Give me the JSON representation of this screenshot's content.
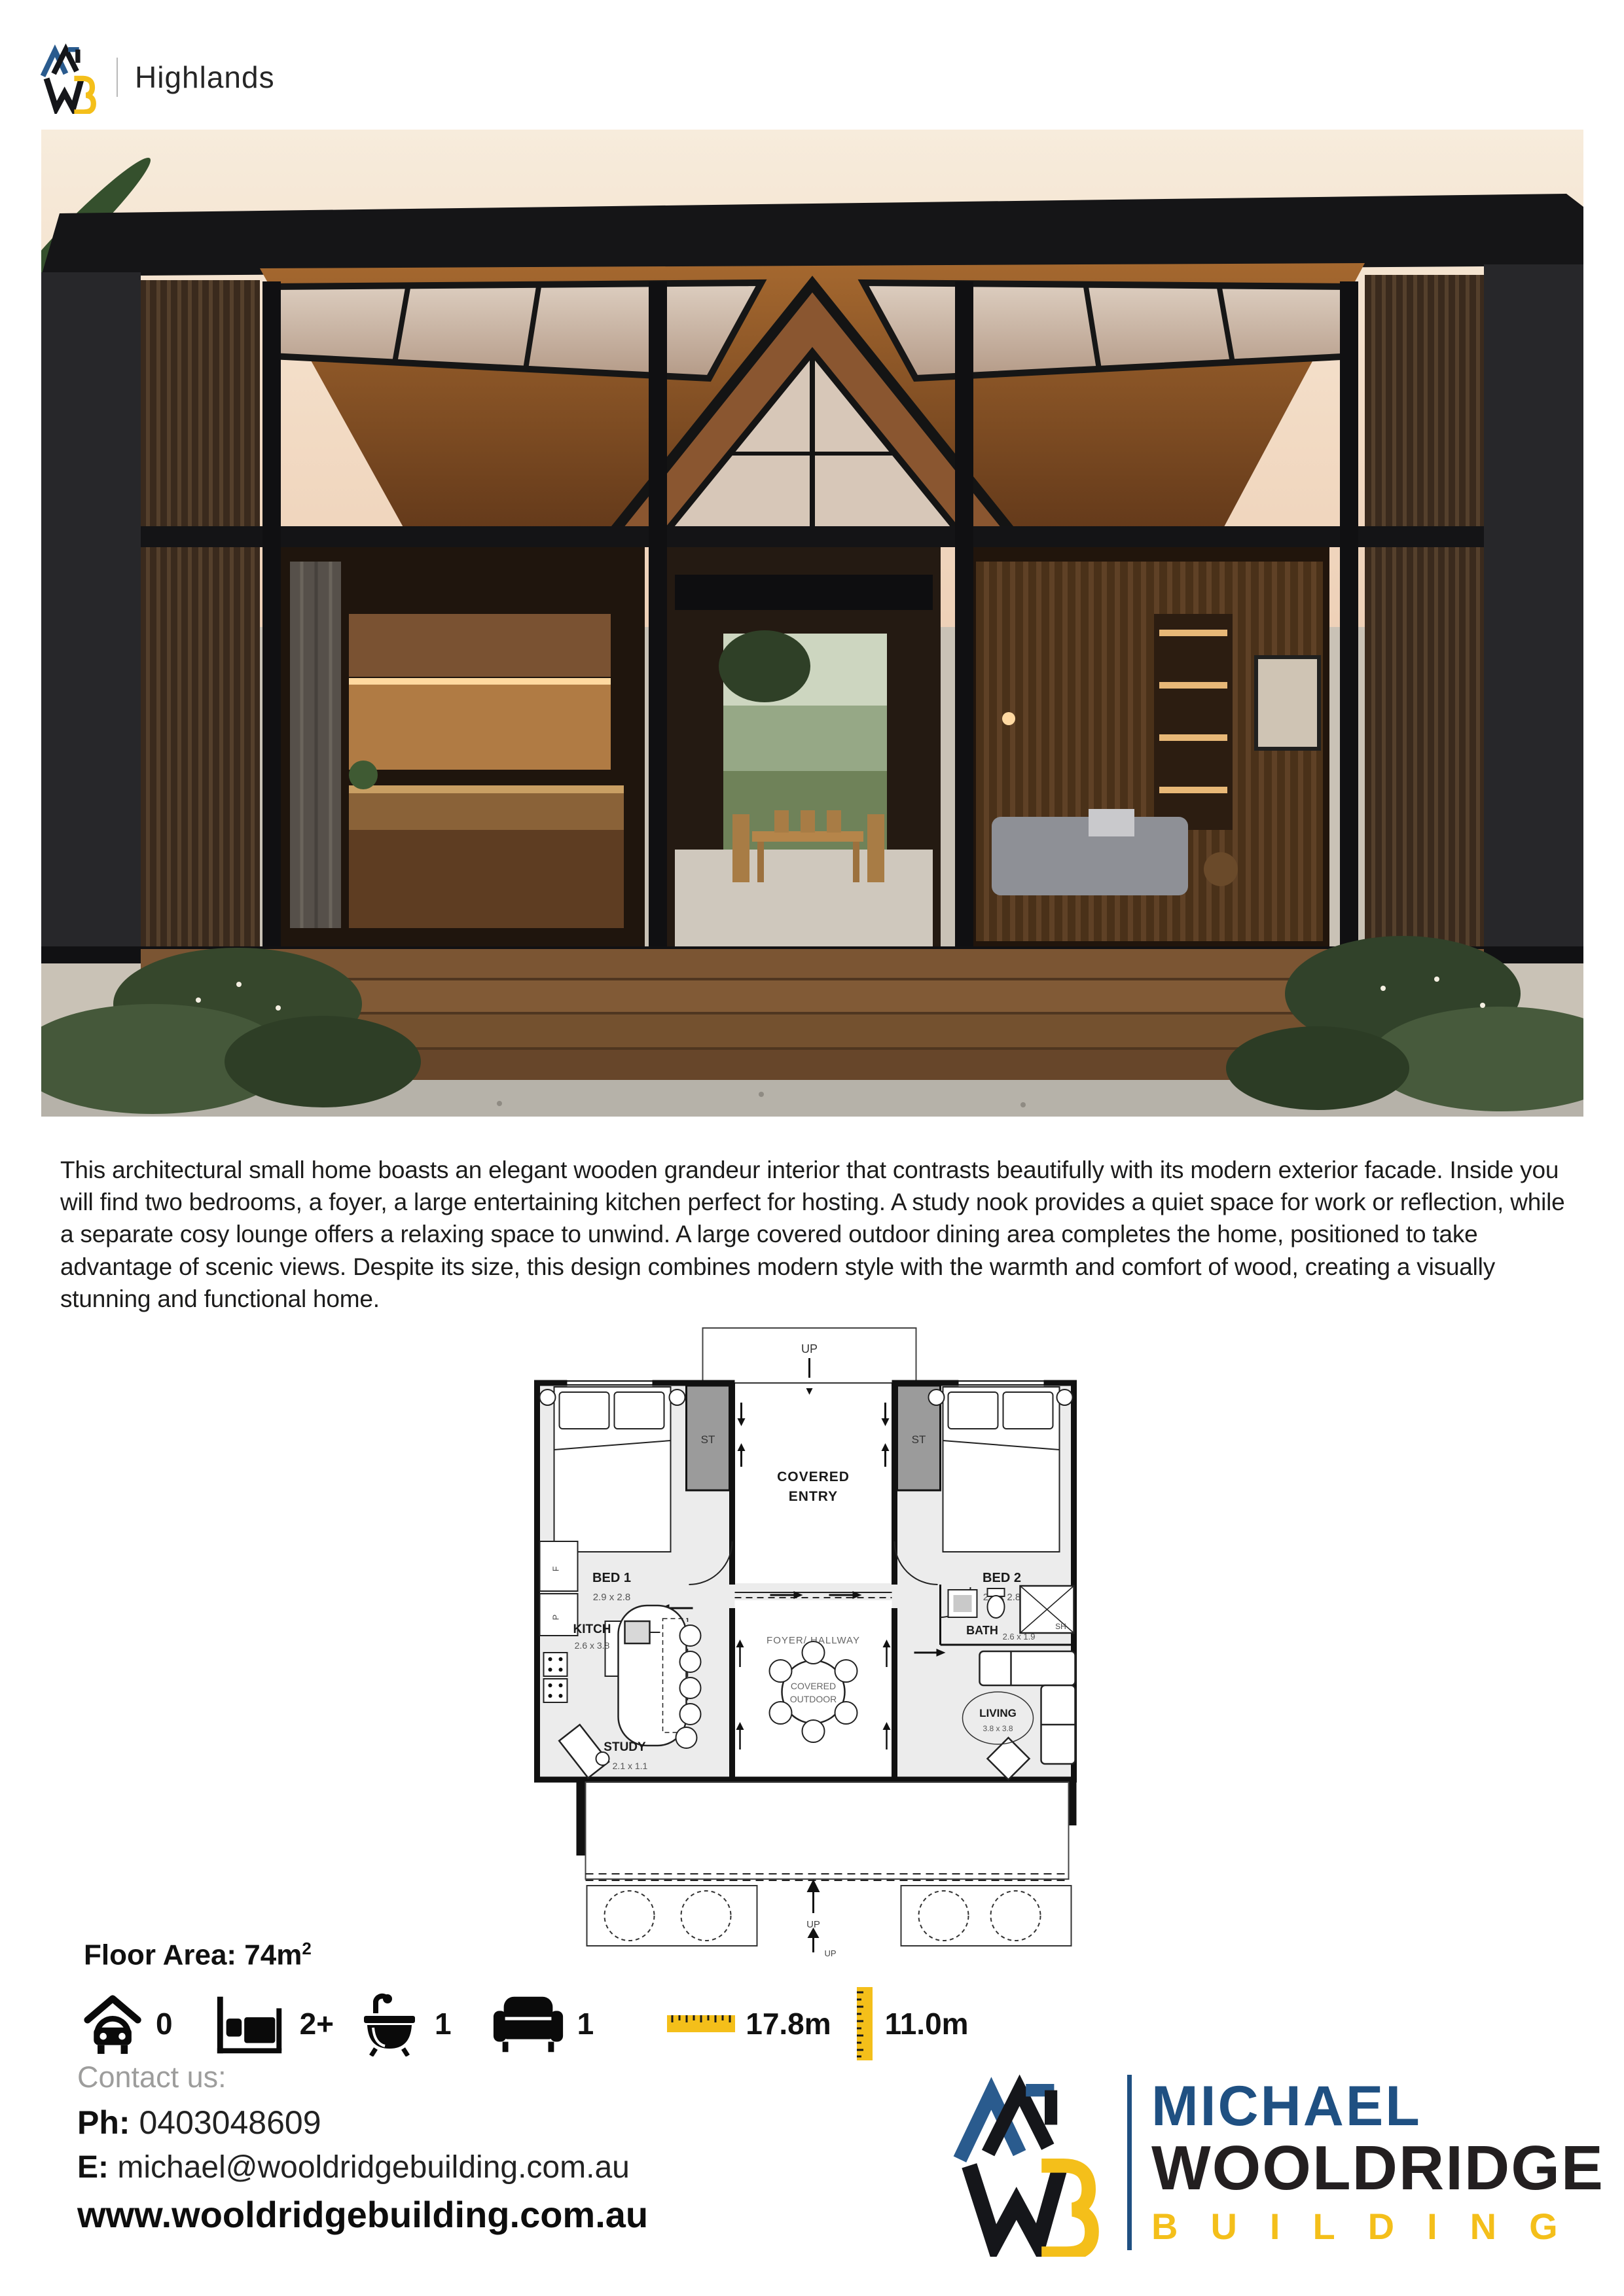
{
  "header": {
    "brand_monogram": "MWB",
    "project_name": "Highlands"
  },
  "description": "This architectural small home boasts an elegant wooden grandeur interior that contrasts beautifully with its modern exterior facade. Inside you will find two bedrooms, a foyer, a large entertaining kitchen perfect for hosting. A study nook provides a quiet space for work or reflection, while a separate cosy lounge offers a relaxing space to unwind. A large covered outdoor dining area completes the home, positioned to take advantage of scenic views. Despite its size, this design combines modern style with the warmth and comfort of wood, creating a visually stunning and functional home.",
  "floor_plan": {
    "up_label": "UP",
    "entry_line1": "COVERED",
    "entry_line2": "ENTRY",
    "storage_left": "ST",
    "storage_right": "ST",
    "bed1_name": "BED 1",
    "bed1_dims": "2.9 x 2.8",
    "bed2_name": "BED 2",
    "bed2_dims": "2.9 x 2.8",
    "foyer": "FOYER/ HALLWAY",
    "dryer": "D",
    "washer": "W",
    "fridge": "F",
    "pantry": "P",
    "kitchen_name": "KITCH",
    "kitchen_dims": "2.6 x 3.8",
    "outdoor_line1": "COVERED",
    "outdoor_line2": "OUTDOOR",
    "bath_name": "BATH",
    "bath_dims": "2.6 x 1.9",
    "shower": "SH",
    "living_name": "LIVING",
    "living_dims": "3.8 x 3.8",
    "study_name": "STUDY",
    "study_dims": "2.1 x 1.1",
    "deck_up1": "UP",
    "deck_up2": "UP"
  },
  "floor_area": {
    "label": "Floor Area: 74m",
    "sup": "2"
  },
  "stats": {
    "carport": "0",
    "bedrooms": "2+",
    "bathrooms": "1",
    "living_rooms": "1",
    "width": "17.8m",
    "depth": "11.0m"
  },
  "contact": {
    "heading": "Contact us:",
    "phone_label": "Ph:",
    "phone_number": "0403048609",
    "email_label": "E:",
    "email_address": "michael@wooldridgebuilding.com.au",
    "website": "www.wooldridgebuilding.com.au"
  },
  "footer_logo": {
    "first": "MICHAEL",
    "last": "WOOLDRIDGE",
    "tagline": "BUILDING"
  },
  "colors": {
    "brand_blue": "#1f5082",
    "brand_yellow": "#f4bf1a",
    "brand_black": "#231f20",
    "muted_gray": "#9d9d9c"
  }
}
